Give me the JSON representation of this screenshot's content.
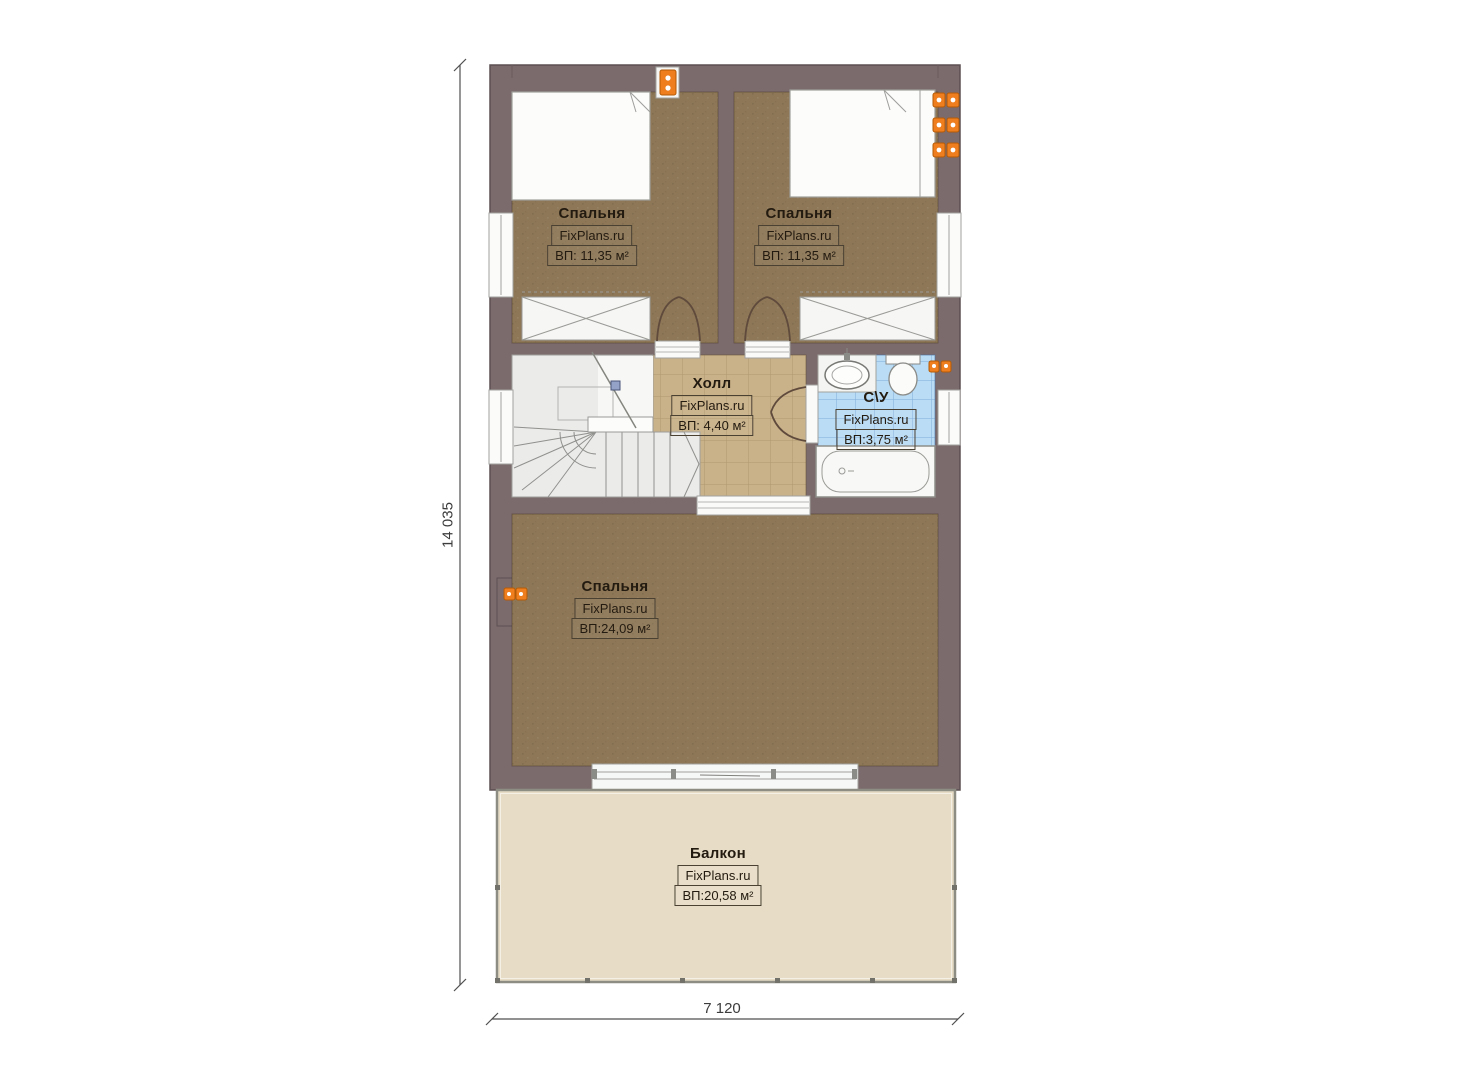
{
  "plan": {
    "watermark": "FixPlans.ru",
    "rooms": [
      {
        "id": "bedroom-top-left",
        "name": "Спальня",
        "watermark": "FixPlans.ru",
        "area": "ВП: 11,35 м²"
      },
      {
        "id": "bedroom-top-right",
        "name": "Спальня",
        "watermark": "FixPlans.ru",
        "area": "ВП: 11,35 м²"
      },
      {
        "id": "hall",
        "name": "Холл",
        "watermark": "FixPlans.ru",
        "area": "ВП: 4,40 м²"
      },
      {
        "id": "bathroom",
        "name": "С\\У",
        "watermark": "FixPlans.ru",
        "area": "ВП:3,75 м²"
      },
      {
        "id": "bedroom-large",
        "name": "Спальня",
        "watermark": "FixPlans.ru",
        "area": "ВП:24,09 м²"
      },
      {
        "id": "balcony",
        "name": "Балкон",
        "watermark": "FixPlans.ru",
        "area": "ВП:20,58 м²"
      }
    ],
    "dimensions": {
      "vertical": "14 035",
      "horizontal": "7 120"
    },
    "colors": {
      "wall": "#7c6b6d",
      "bedroom_floor": "#8d7757",
      "hall_floor": "#c9b28a",
      "bathroom_floor": "#badcf4",
      "balcony_floor": "#e7ddc7",
      "stairs_floor": "#ebebea",
      "accent_orange": "#ee7e1e"
    }
  }
}
